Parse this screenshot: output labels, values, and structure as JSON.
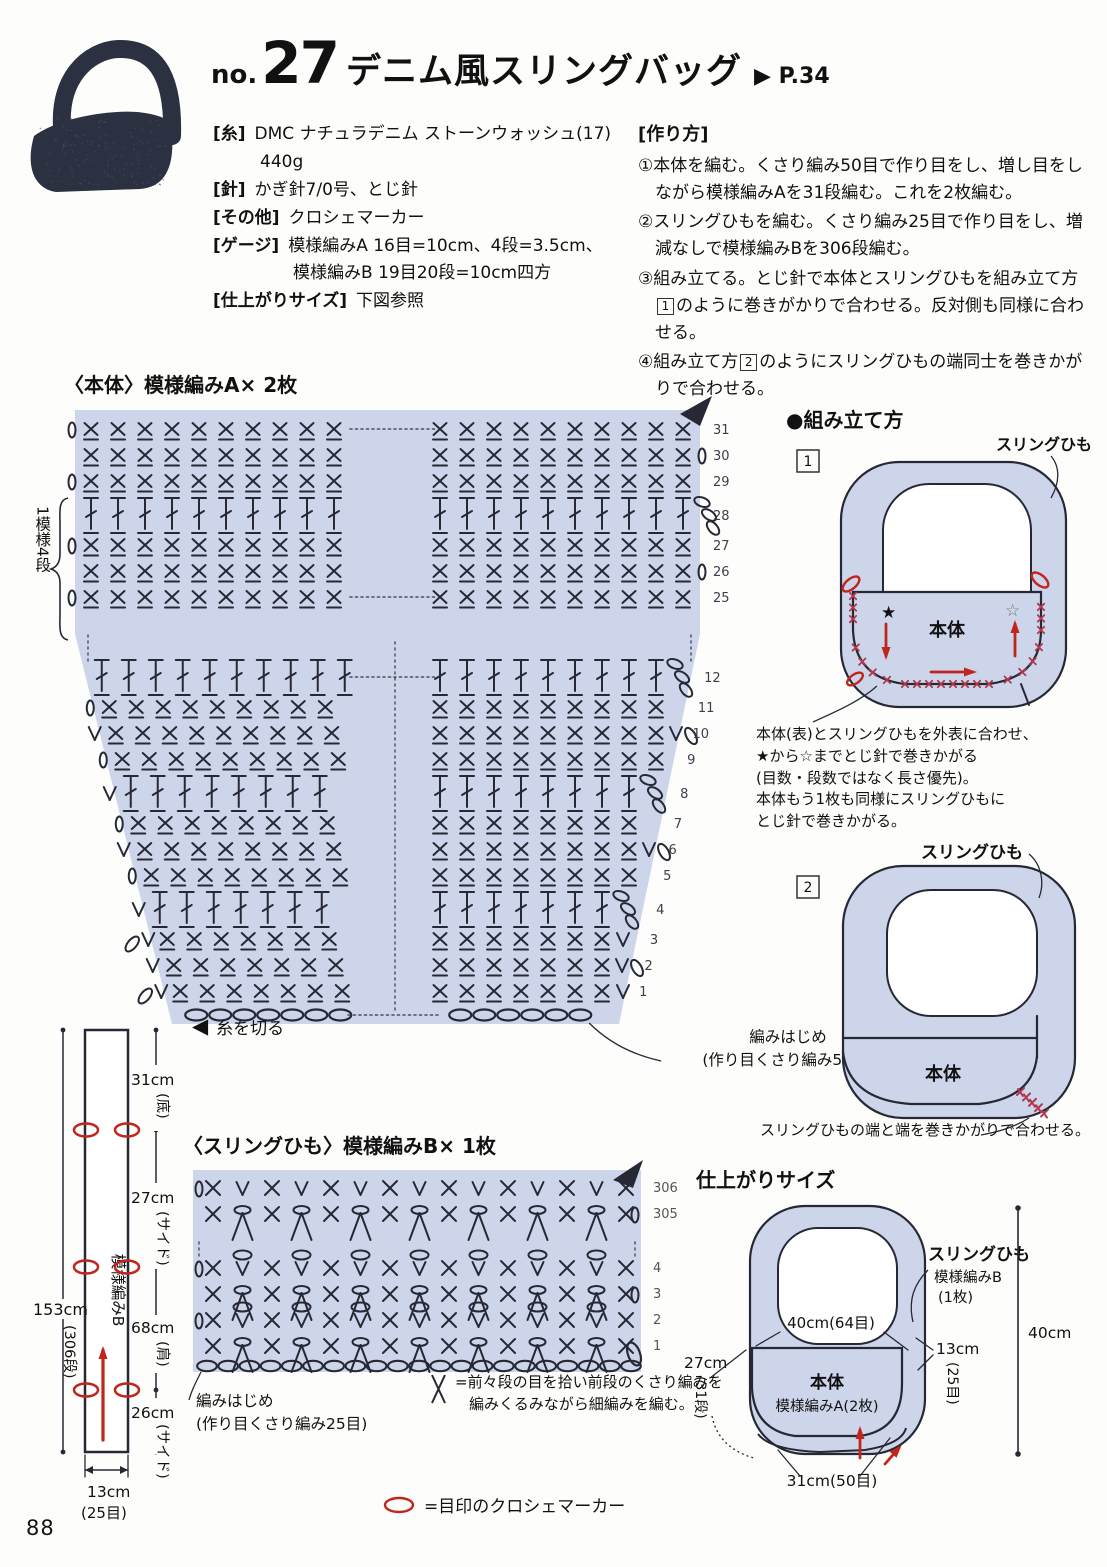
{
  "colors": {
    "ink": "#262935",
    "lavender": "#ccd5e9",
    "red": "#c1251c",
    "stitch_red": "#b23850",
    "photo_navy": "#2b3140",
    "number_gray": "#3c3f4a"
  },
  "page": {
    "number": "88"
  },
  "header": {
    "no_label": "no.",
    "number": "27",
    "title": "デニム風スリングバッグ",
    "page_ref": "▶ P.34"
  },
  "materials": {
    "items": [
      {
        "label": "[糸]",
        "value": "DMC ナチュラデニム ストーンウォッシュ(17)",
        "value2": "440g"
      },
      {
        "label": "[針]",
        "value": "かぎ針7/0号、とじ針"
      },
      {
        "label": "[その他]",
        "value": "クロシェマーカー"
      },
      {
        "label": "[ゲージ]",
        "value": "模様編みA 16目=10cm、4段=3.5cm、",
        "value2": "模様編みB 19目20段=10cm四方"
      },
      {
        "label": "[仕上がりサイズ]",
        "value": "下図参照"
      }
    ]
  },
  "instructions": {
    "heading": "[作り方]",
    "steps": [
      {
        "text": "①本体を編む。くさり編み50目で作り目をし、増し目をしながら模様編みAを31段編む。これを2枚編む。"
      },
      {
        "text": "②スリングひもを編む。くさり編み25目で作り目をし、増減なしで模様編みBを306段編む。"
      },
      {
        "pre": "③組み立てる。とじ針で本体とスリングひもを組み立て方",
        "box": "1",
        "post": "のように巻きがかりで合わせる。反対側も同様に合わせる。"
      },
      {
        "pre": "④組み立て方",
        "box": "2",
        "post": "のようにスリングひもの端同士を巻きかがりで合わせる。"
      }
    ]
  },
  "chart_a": {
    "title": "〈本体〉模様編みA× 2枚",
    "repeat_note": "1模様4段",
    "cut_label": "糸を切る",
    "start_label": "編みはじめ",
    "start_sub": "(作り目くさり編み50目)",
    "rows": [
      {
        "n": 31,
        "t": "sc",
        "L": "0",
        "dots": true
      },
      {
        "n": 30,
        "t": "sc",
        "R": "0"
      },
      {
        "n": 29,
        "t": "sc",
        "L": "0"
      },
      {
        "n": 28,
        "t": "dc",
        "R": "ch3"
      },
      {
        "n": 27,
        "t": "sc",
        "L": "0"
      },
      {
        "n": 26,
        "t": "sc",
        "R": "0"
      },
      {
        "n": 25,
        "t": "sc",
        "L": "0",
        "dots": true
      },
      {
        "gap": true
      },
      {
        "n": 12,
        "t": "dc",
        "R": "ch3",
        "dots": true
      },
      {
        "n": 11,
        "t": "sc",
        "L": "0"
      },
      {
        "n": 10,
        "t": "sc",
        "L": "V",
        "R": "V0"
      },
      {
        "n": 9,
        "t": "sc",
        "L": "0"
      },
      {
        "n": 8,
        "t": "dc",
        "L": "V",
        "R": "ch3"
      },
      {
        "n": 7,
        "t": "sc",
        "L": "0"
      },
      {
        "n": 6,
        "t": "sc",
        "L": "V",
        "R": "V0"
      },
      {
        "n": 5,
        "t": "sc",
        "L": "0"
      },
      {
        "n": 4,
        "t": "dc",
        "L": "V",
        "R": "ch3"
      },
      {
        "n": 3,
        "t": "sc",
        "L": "oV",
        "R": "V"
      },
      {
        "n": 2,
        "t": "sc",
        "L": "V",
        "R": "V0"
      },
      {
        "n": 1,
        "t": "sc",
        "L": "oV",
        "R": "V"
      },
      {
        "chain": true,
        "dots": true
      }
    ]
  },
  "assembly": {
    "heading": "●組み立て方",
    "d1": {
      "num": "1",
      "strap_label": "スリングひも",
      "body_label": "本体",
      "star_filled": "★",
      "star_open": "☆",
      "caption": [
        "本体(表)とスリングひもを外表に合わせ、",
        "★から☆までとじ針で巻きかがる",
        "(目数・段数ではなく長さ優先)。",
        "本体もう1枚も同様にスリングひもに",
        "とじ針で巻きかがる。"
      ]
    },
    "d2": {
      "num": "2",
      "strap_label": "スリングひも",
      "body_label": "本体",
      "caption": "スリングひもの端と端を巻きかがりで合わせる。"
    }
  },
  "chart_b": {
    "title": "〈スリングひも〉模様編みB× 1枚",
    "start_label": "編みはじめ",
    "start_sub": "(作り目くさり編み25目)",
    "legend_line1": "=前々段の目を拾い前段のくさり編みを",
    "legend_line2": "編みくるみながら細編みを編む。",
    "rows": [
      {
        "n": 306,
        "st": "xv",
        "L": "0"
      },
      {
        "n": 305,
        "st": "xa",
        "R": "0"
      },
      {
        "gap": true
      },
      {
        "n": 4,
        "st": "xvo",
        "L": "0"
      },
      {
        "n": 3,
        "st": "xa",
        "R": "0"
      },
      {
        "n": 2,
        "st": "xvo",
        "L": "0"
      },
      {
        "n": 1,
        "st": "xa",
        "R": "loop"
      },
      {
        "chain": true
      }
    ]
  },
  "strip": {
    "pattern_label": "模様編みB",
    "total": "153cm",
    "total_sub": "(306段)",
    "seg1": "31cm",
    "seg1_sub": "(底)",
    "seg2": "27cm",
    "seg2_sub": "(サイド)",
    "seg3": "68cm",
    "seg3_sub": "(肩)",
    "seg4": "26cm",
    "seg4_sub": "(サイド)",
    "width": "13cm",
    "width_sub": "(25目)",
    "marker_legend": "=目印のクロシェマーカー"
  },
  "finished": {
    "heading": "仕上がりサイズ",
    "strap_label": "スリングひも",
    "strap_sub1": "模様編みB",
    "strap_sub2": "(1枚)",
    "body_label": "本体",
    "body_sub": "模様編みA(2枚)",
    "top_dim": "40cm(64目)",
    "left_dim": "27cm",
    "left_dim_sub": "(31段)",
    "right_dim": "13cm",
    "right_dim_sub": "(25目)",
    "bottom_dim": "31cm(50目)",
    "height_dim": "40cm"
  }
}
